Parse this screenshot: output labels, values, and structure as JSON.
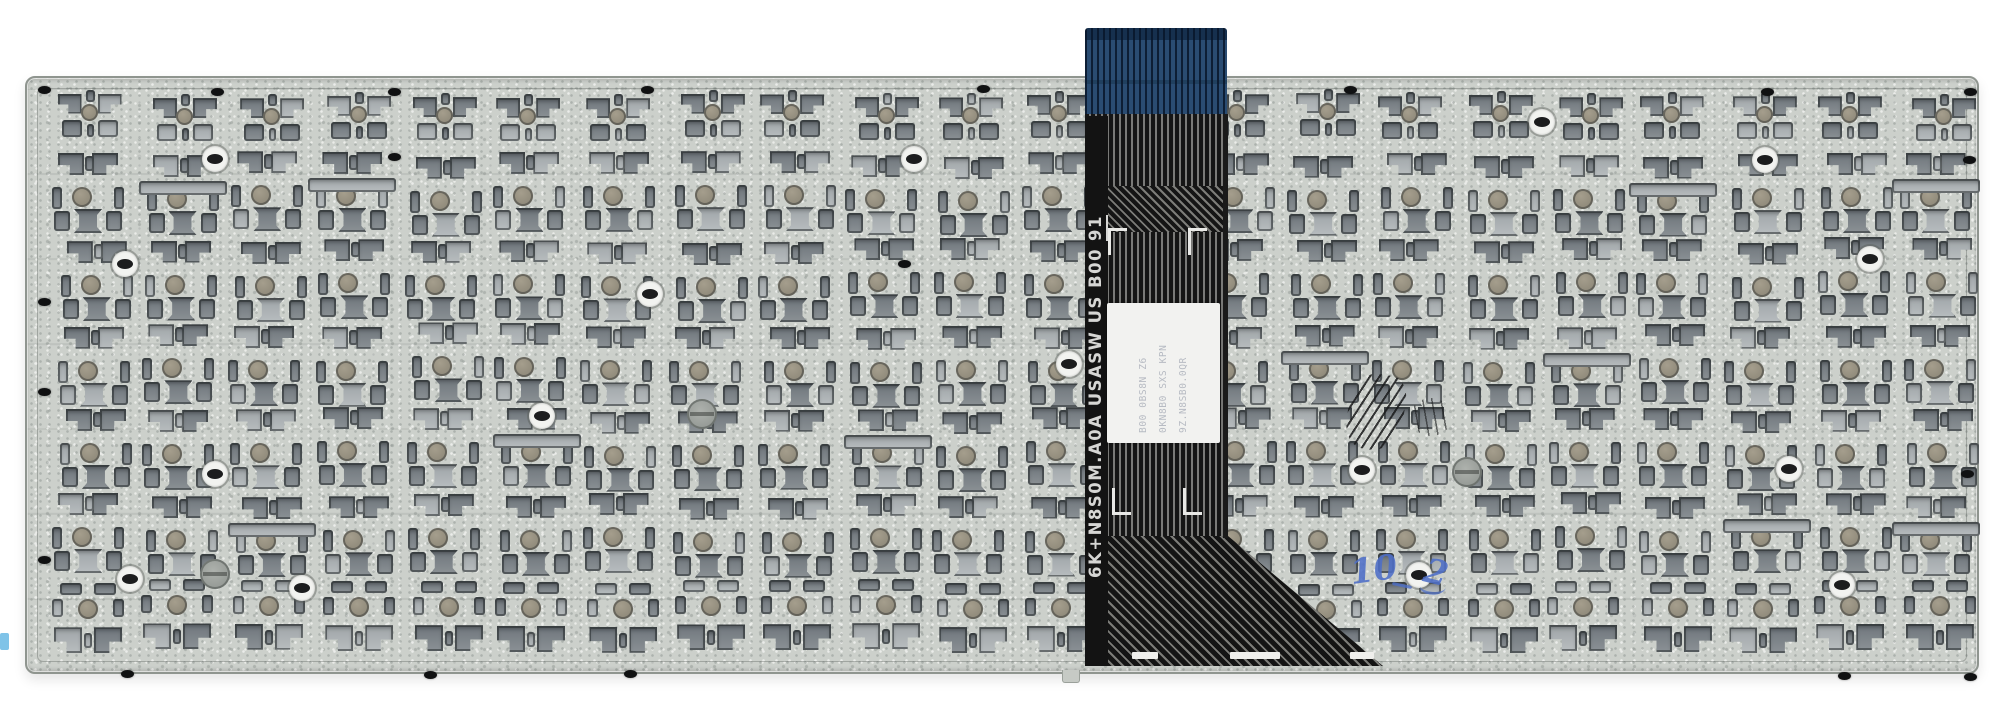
{
  "canvas": {
    "width": 2000,
    "height": 716,
    "background_color": "#ffffff"
  },
  "plate": {
    "x": 25,
    "y": 76,
    "width": 1950,
    "height": 594,
    "base_color": "#ccd0cb",
    "cutout_color": "#7b8287",
    "cutout_edge_color": "#43484c",
    "pattern": {
      "col_start": 54,
      "col_pitch": 88,
      "col_count": 22,
      "cluster_width": 72,
      "rows": [
        {
          "y": 90,
          "h": 52,
          "style": "A"
        },
        {
          "y": 152,
          "h": 82,
          "style": "B"
        },
        {
          "y": 238,
          "h": 82,
          "style": "B"
        },
        {
          "y": 323,
          "h": 82,
          "style": "B"
        },
        {
          "y": 408,
          "h": 82,
          "style": "B"
        },
        {
          "y": 493,
          "h": 82,
          "style": "B"
        },
        {
          "y": 580,
          "h": 80,
          "style": "C"
        }
      ]
    },
    "ring_holes": [
      [
        213,
        157
      ],
      [
        648,
        292
      ],
      [
        123,
        262
      ],
      [
        1067,
        362
      ],
      [
        1360,
        468
      ],
      [
        1417,
        573
      ],
      [
        1763,
        158
      ],
      [
        1868,
        257
      ],
      [
        1787,
        467
      ],
      [
        1840,
        583
      ],
      [
        213,
        472
      ],
      [
        128,
        577
      ],
      [
        912,
        157
      ],
      [
        540,
        414
      ],
      [
        300,
        586
      ],
      [
        1540,
        120
      ]
    ],
    "rivets": [
      [
        42,
        88
      ],
      [
        215,
        90
      ],
      [
        392,
        90
      ],
      [
        645,
        88
      ],
      [
        981,
        87
      ],
      [
        1348,
        88
      ],
      [
        1765,
        90
      ],
      [
        1968,
        90
      ],
      [
        1967,
        158
      ],
      [
        1965,
        472
      ],
      [
        1968,
        675
      ],
      [
        42,
        300
      ],
      [
        42,
        390
      ],
      [
        42,
        558
      ],
      [
        125,
        672
      ],
      [
        428,
        673
      ],
      [
        628,
        672
      ],
      [
        1842,
        674
      ],
      [
        392,
        155
      ],
      [
        902,
        262
      ]
    ],
    "screw_discs": [
      [
        213,
        572
      ],
      [
        1465,
        470
      ],
      [
        700,
        412
      ]
    ],
    "bottom_tab": {
      "x": 1060,
      "y": 668,
      "w": 16,
      "h": 12
    }
  },
  "ribbon": {
    "connector": {
      "x": 1085,
      "y": 28,
      "w": 142,
      "h": 88,
      "color": "#2a4c72"
    },
    "body": {
      "x": 1085,
      "y": 114,
      "w": 143,
      "h": 424,
      "color": "#151515",
      "trace_color": "#7a7a78"
    },
    "zigzag_band": {
      "x": 1085,
      "y": 186,
      "w": 143,
      "h": 46
    },
    "flare": {
      "x": 1085,
      "y": 536,
      "w": 298,
      "h": 130
    },
    "marking": {
      "prefix": "6K+N8S0M.A0A USASW US B00 ",
      "suffix": "91",
      "color": "#d6d6d4"
    },
    "label": {
      "x": 1107,
      "y": 303,
      "w": 113,
      "h": 140,
      "color": "#f2f2f0",
      "lines": [
        "9Z.N8SB0.0QR",
        "0KN8B0 SXS KPN",
        "B00 0BS8N Z6"
      ]
    },
    "fiducials_top": [
      [
        1108,
        228
      ],
      [
        1188,
        228
      ]
    ],
    "fiducials_bottom": [
      [
        1112,
        488
      ],
      [
        1183,
        488
      ]
    ],
    "solder_pads": [
      [
        1132,
        652,
        26
      ],
      [
        1230,
        652,
        50
      ],
      [
        1350,
        652,
        24
      ]
    ]
  },
  "annotations": {
    "handwriting": {
      "left": "10",
      "right": "2",
      "color": "#4e6fc8"
    },
    "ink_smudge": {
      "x": 1348,
      "y": 374,
      "w": 56,
      "h": 76
    },
    "margin_mark": {
      "x": 0,
      "y": 633,
      "w": 9,
      "h": 17,
      "color": "#7fc3e8"
    }
  }
}
